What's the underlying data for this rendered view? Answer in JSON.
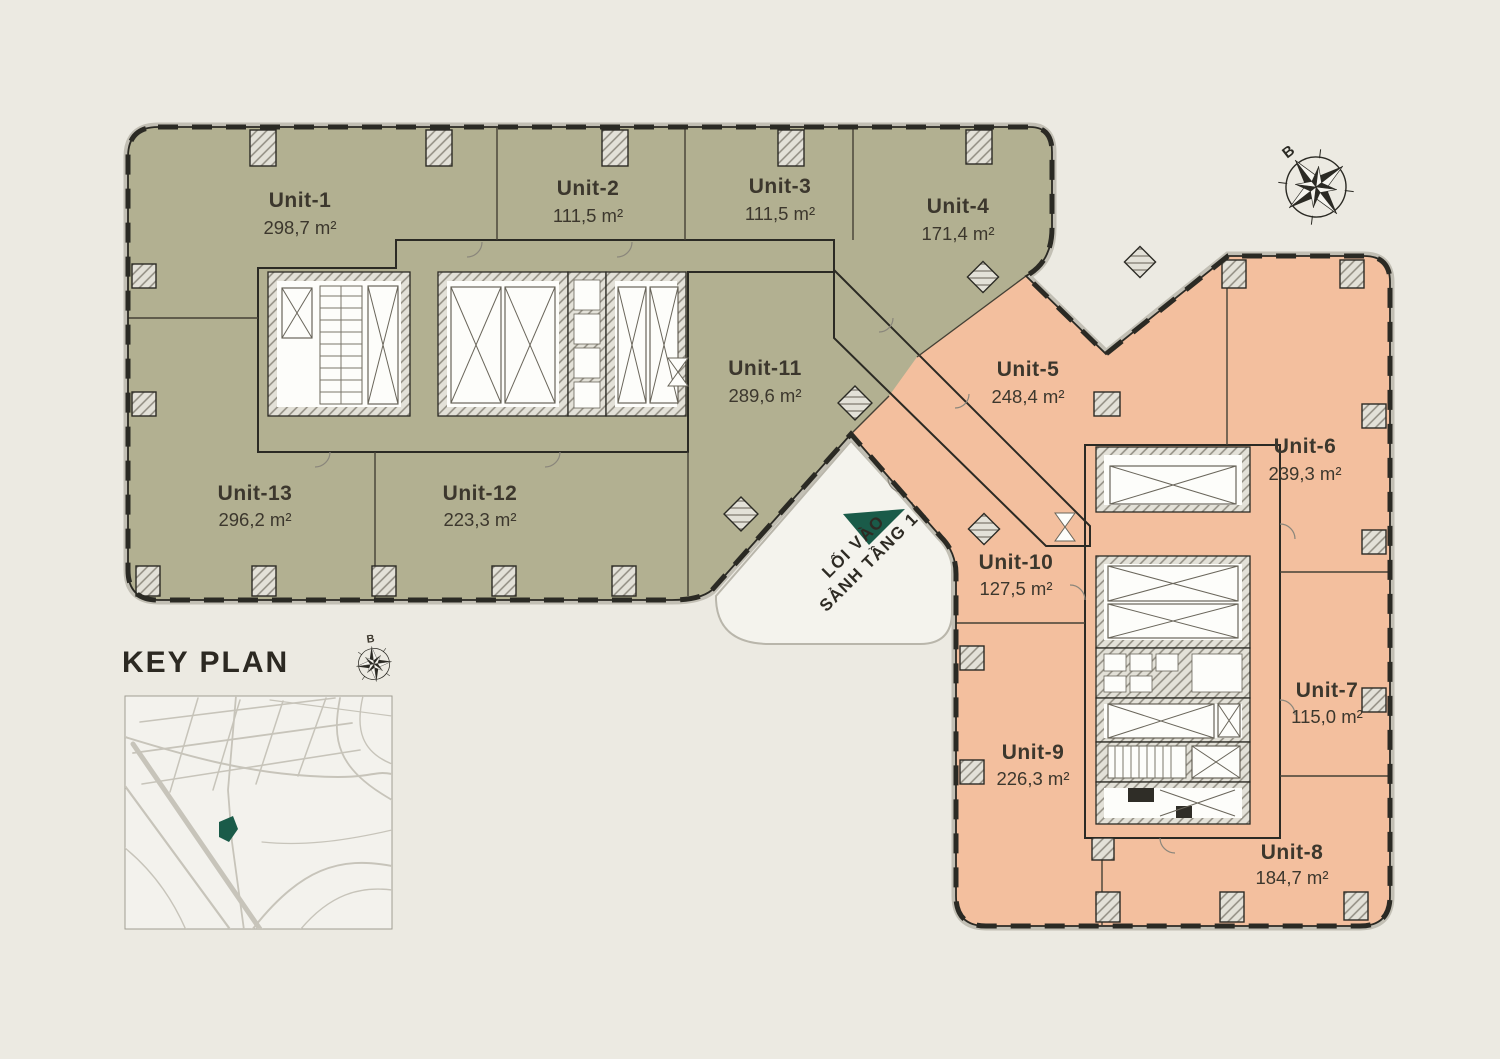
{
  "plan": {
    "units": [
      {
        "name": "Unit-1",
        "area": "298,7 m²"
      },
      {
        "name": "Unit-2",
        "area": "111,5 m²"
      },
      {
        "name": "Unit-3",
        "area": "111,5 m²"
      },
      {
        "name": "Unit-4",
        "area": "171,4 m²"
      },
      {
        "name": "Unit-5",
        "area": "248,4 m²"
      },
      {
        "name": "Unit-6",
        "area": "239,3 m²"
      },
      {
        "name": "Unit-7",
        "area": "115,0 m²"
      },
      {
        "name": "Unit-8",
        "area": "184,7 m²"
      },
      {
        "name": "Unit-9",
        "area": "226,3 m²"
      },
      {
        "name": "Unit-10",
        "area": "127,5 m²"
      },
      {
        "name": "Unit-11",
        "area": "289,6 m²"
      },
      {
        "name": "Unit-12",
        "area": "223,3 m²"
      },
      {
        "name": "Unit-13",
        "area": "296,2 m²"
      }
    ]
  },
  "key_plan": {
    "title": "KEY PLAN"
  },
  "entrance": {
    "line1": "LỐI VÀO",
    "line2": "SẢNH TẦNG 1"
  },
  "compass": {
    "north_label": "B"
  },
  "colors": {
    "bg": "#ECEAE2",
    "olive": "#B2B091",
    "peach": "#F3BF9E",
    "white": "#F7F6F1",
    "ink": "#2B2A24",
    "green": "#1A5B49",
    "text": "#3C372D",
    "street": "#C7C4BA",
    "mapbg": "#F3F2ED",
    "pave": "#C2BFB4"
  }
}
